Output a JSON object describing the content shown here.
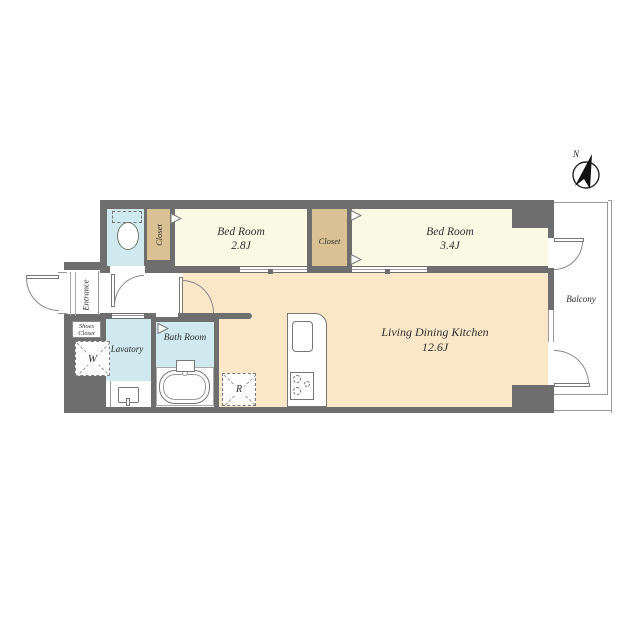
{
  "colors": {
    "wall": "#6e6e6e",
    "floor-cream": "#faf9e3",
    "floor-tan": "#d9c193",
    "floor-peach": "#fae7c8",
    "floor-blue": "#cfe9ef",
    "line": "#8c8c8c",
    "text": "#2e2e2e"
  },
  "rooms": {
    "bedroom1": {
      "name": "Bed Room",
      "area": "2.8J"
    },
    "bedroom2": {
      "name": "Bed Room",
      "area": "3.4J"
    },
    "ldk": {
      "name": "Living Dining Kitchen",
      "area": "12.6J"
    },
    "bath": {
      "name": "Bath Room"
    },
    "lavatory": {
      "name": "Lavatory"
    },
    "entrance": {
      "name": "Entrance"
    },
    "shoes_closet": {
      "name": "Shoes Closet"
    },
    "closet1": {
      "name": "Closet"
    },
    "closet2": {
      "name": "Closet"
    },
    "balcony": {
      "name": "Balcony"
    }
  },
  "symbols": {
    "washing_machine": "W",
    "refrigerator": "R",
    "north": "N"
  }
}
